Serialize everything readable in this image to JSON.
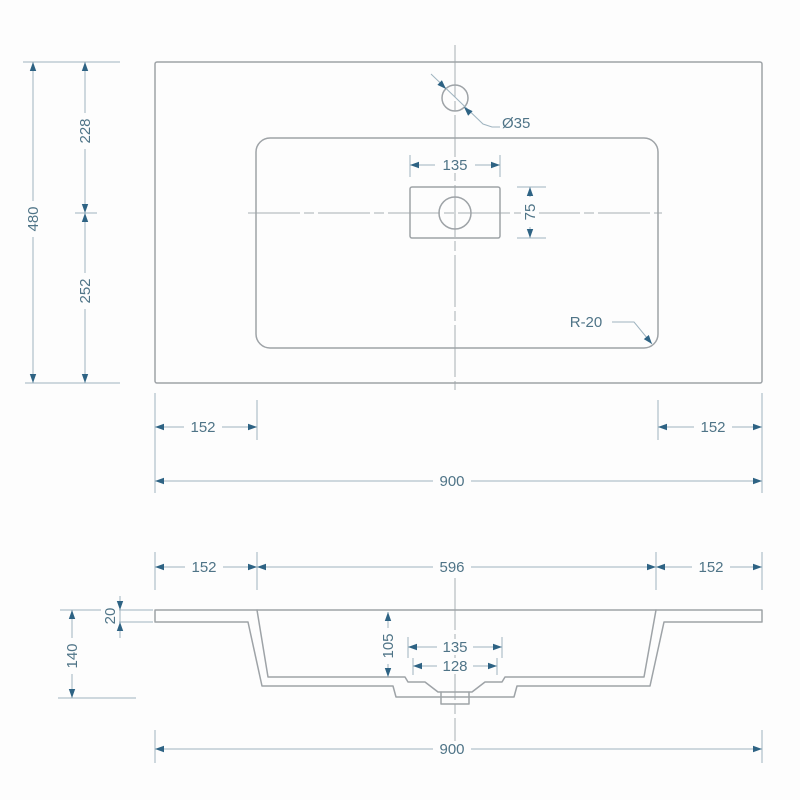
{
  "colors": {
    "geometry_line": "#9EA3A7",
    "dimension_line": "#9FB4C0",
    "arrow": "#2E6384",
    "text": "#4F7487",
    "background": "#FDFDFD"
  },
  "plan_view": {
    "width_total": "900",
    "offset_left": "152",
    "offset_right": "152",
    "depth_total": "480",
    "depth_upper": "228",
    "depth_lower": "252",
    "faucet_diameter": "Ø35",
    "drain_width": "135",
    "drain_height": "75",
    "corner_radius": "R-20"
  },
  "section_view": {
    "offset_left": "152",
    "opening_width": "596",
    "offset_right": "152",
    "rim_thickness": "20",
    "height_total": "140",
    "bowl_depth": "105",
    "recess_width_top": "135",
    "recess_width_bottom": "128",
    "width_total": "900"
  }
}
